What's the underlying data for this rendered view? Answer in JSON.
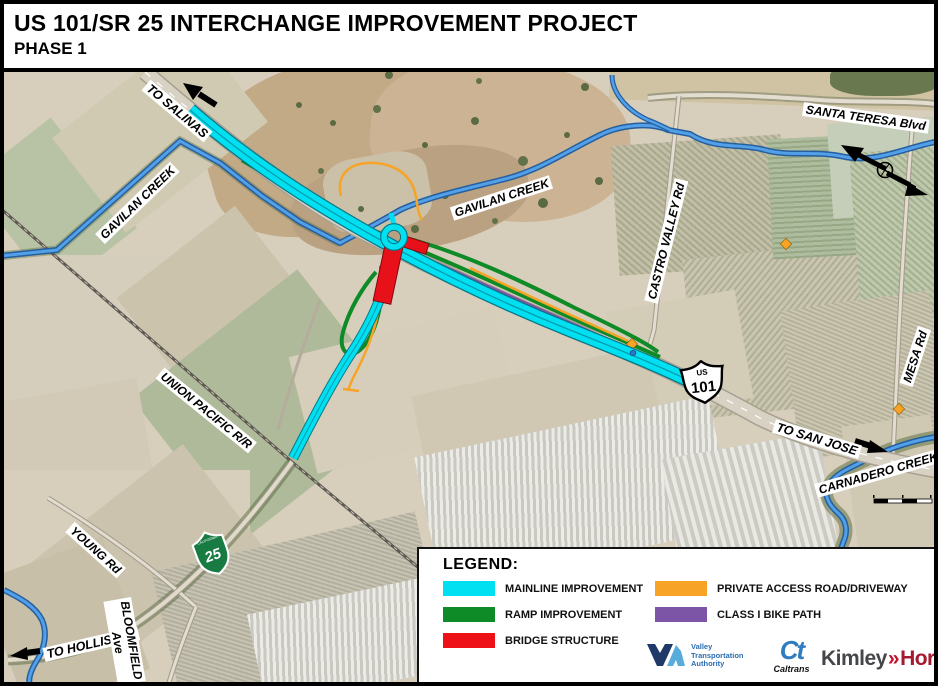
{
  "title": {
    "line1": "US 101/SR 25 INTERCHANGE IMPROVEMENT PROJECT",
    "line2": "PHASE 1"
  },
  "map": {
    "labels": [
      {
        "id": "to-salinas",
        "text": "TO SALINAS"
      },
      {
        "id": "gavilan-creek-west",
        "text": "GAVILAN CREEK"
      },
      {
        "id": "gavilan-creek-east",
        "text": "GAVILAN CREEK"
      },
      {
        "id": "santa-teresa-blvd",
        "text": "SANTA TERESA Blvd"
      },
      {
        "id": "castro-valley-rd",
        "text": "CASTRO VALLEY Rd"
      },
      {
        "id": "mesa-rd",
        "text": "MESA Rd"
      },
      {
        "id": "union-pacific-rr",
        "text": "UNION PACIFIC R/R"
      },
      {
        "id": "to-san-jose",
        "text": "TO SAN JOSE"
      },
      {
        "id": "carnadero-creek",
        "text": "CARNADERO CREEK"
      },
      {
        "id": "young-rd",
        "text": "YOUNG Rd"
      },
      {
        "id": "to-hollister",
        "text": "TO HOLLISTER"
      },
      {
        "id": "bloomfield-ave",
        "text": "BLOOMFIELD",
        "text2": "Ave"
      }
    ],
    "shields": {
      "us101": {
        "top": "US",
        "number": "101"
      },
      "sr25": {
        "state": "CALIFORNIA",
        "number": "25"
      }
    }
  },
  "legend": {
    "heading": "LEGEND:",
    "items": [
      {
        "label": "MAINLINE IMPROVEMENT",
        "color": "#00E0F0"
      },
      {
        "label": "RAMP IMPROVEMENT",
        "color": "#0E8B26"
      },
      {
        "label": "BRIDGE STRUCTURE",
        "color": "#EE1118"
      },
      {
        "label": "PRIVATE ACCESS ROAD/DRIVEWAY",
        "color": "#F7A426"
      },
      {
        "label": "CLASS I BIKE PATH",
        "color": "#7D55A7"
      }
    ]
  },
  "logos": {
    "vta": {
      "line1": "Valley",
      "line2": "Transportation",
      "line3": "Authority"
    },
    "caltrans": {
      "mark": "Ct",
      "wordmark": "Caltrans"
    },
    "kimley_horn": {
      "part1": "Kimley",
      "separator": "»",
      "part2": "Horn"
    }
  },
  "colors": {
    "mainline": "#00E0F0",
    "ramp": "#0E8B26",
    "bridge": "#EE1118",
    "private_access": "#F7A426",
    "bike_path": "#7D55A7",
    "creek": "#54A0E8"
  }
}
